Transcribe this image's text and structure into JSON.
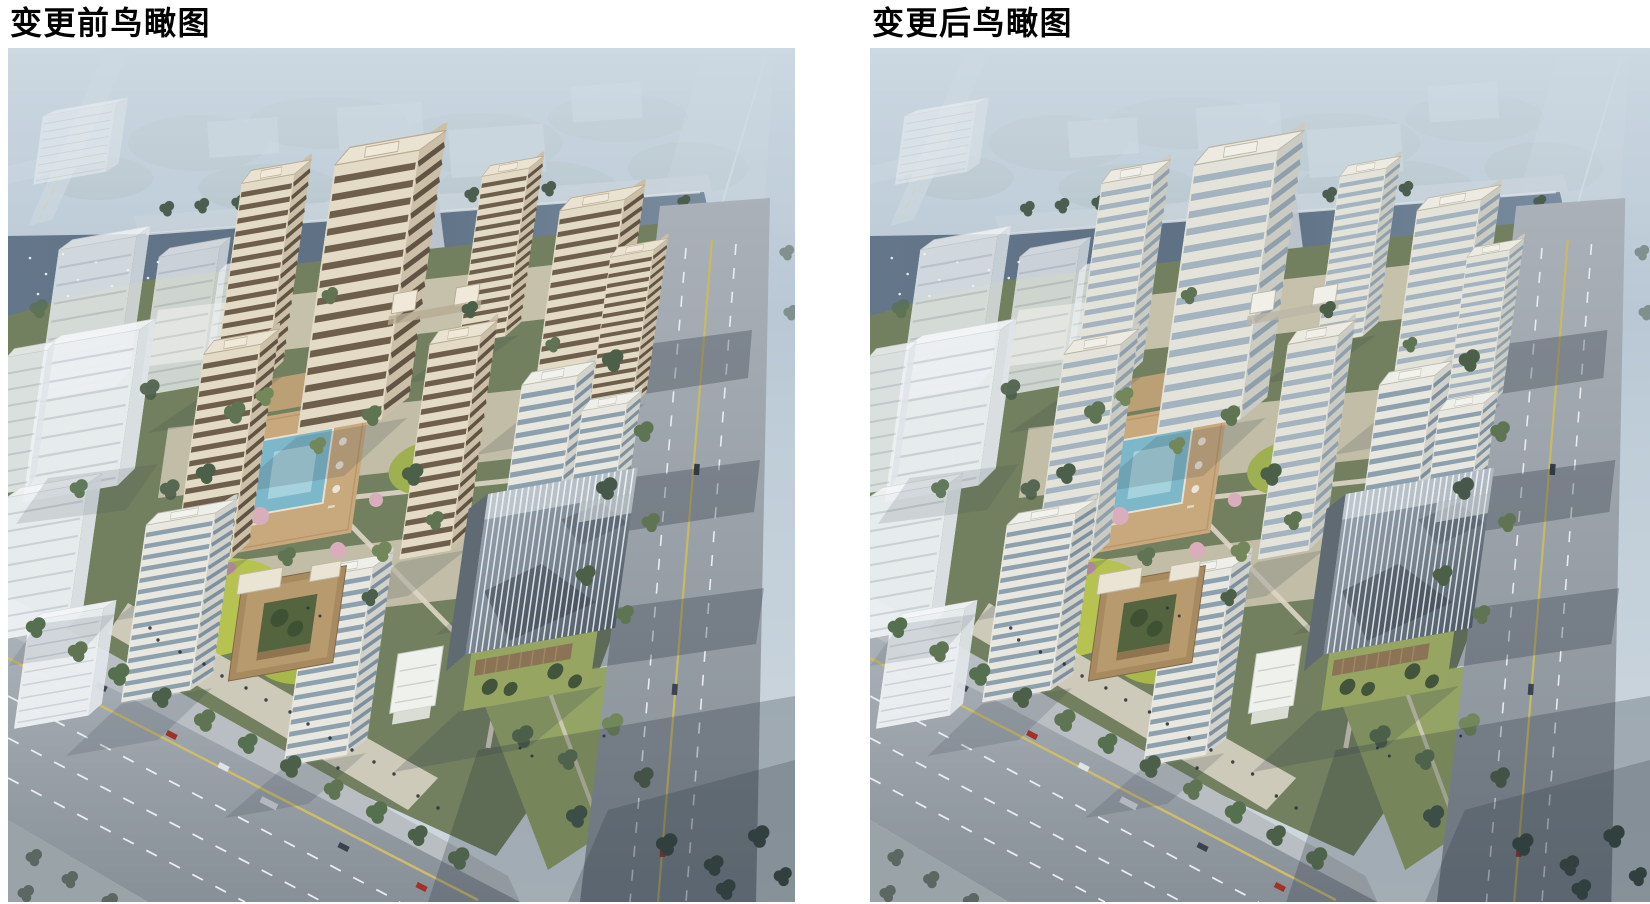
{
  "figures": [
    {
      "caption": "变更前鸟瞰图",
      "facade_vars": "--roof:#eae3d1;--roofEdge:#b7ab93;--ffront:#e4dbc6;--fside:#cbbfa7;--band:#6e5f4c;--bandSide:#5b4e3f;--crown:#f0e9d9"
    },
    {
      "caption": "变更后鸟瞰图",
      "facade_vars": "--roof:#edebe1;--roofEdge:#bab5a6;--ffront:#e4e3da;--fside:#caccc3;--band:#a3b3c0;--bandSide:#8c9dab;--crown:#f1f0e8"
    }
  ],
  "key_colors": {
    "page_background": "#ffffff",
    "caption_text": "#000000",
    "before_window_band": "#6e5f4c",
    "after_window_band": "#a3b3c0",
    "facade_cream": "#e4dbc6",
    "river_water": "#5d7084",
    "road_asphalt": "#9aa2aa",
    "courtyard_lawn": "#b6c351",
    "pool_water": "#7cb7ca"
  }
}
